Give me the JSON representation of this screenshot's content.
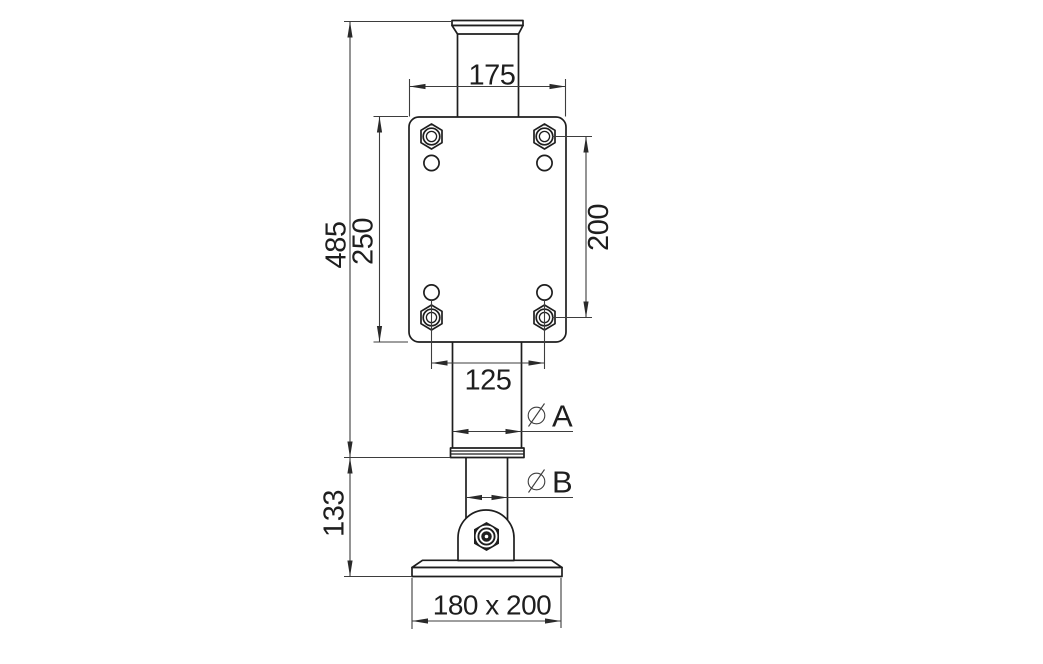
{
  "colors": {
    "background": "#ffffff",
    "object_line": "#1e1e1e",
    "dimension_line": "#3d3d3d",
    "text": "#1e1e1e"
  },
  "dimensions": {
    "plate_width": {
      "label": "175"
    },
    "plate_height": {
      "label": "250"
    },
    "hole_spacing_vertical": {
      "label": "200"
    },
    "hole_spacing_horizontal": {
      "label": "125"
    },
    "upper_section_height": {
      "label": "485"
    },
    "lower_section_height": {
      "label": "133"
    },
    "diameter_a": {
      "symbol": "diameter-icon",
      "label": "A"
    },
    "diameter_b": {
      "symbol": "diameter-icon",
      "label": "B"
    },
    "base_plate_size": {
      "label": "180 x 200"
    }
  }
}
